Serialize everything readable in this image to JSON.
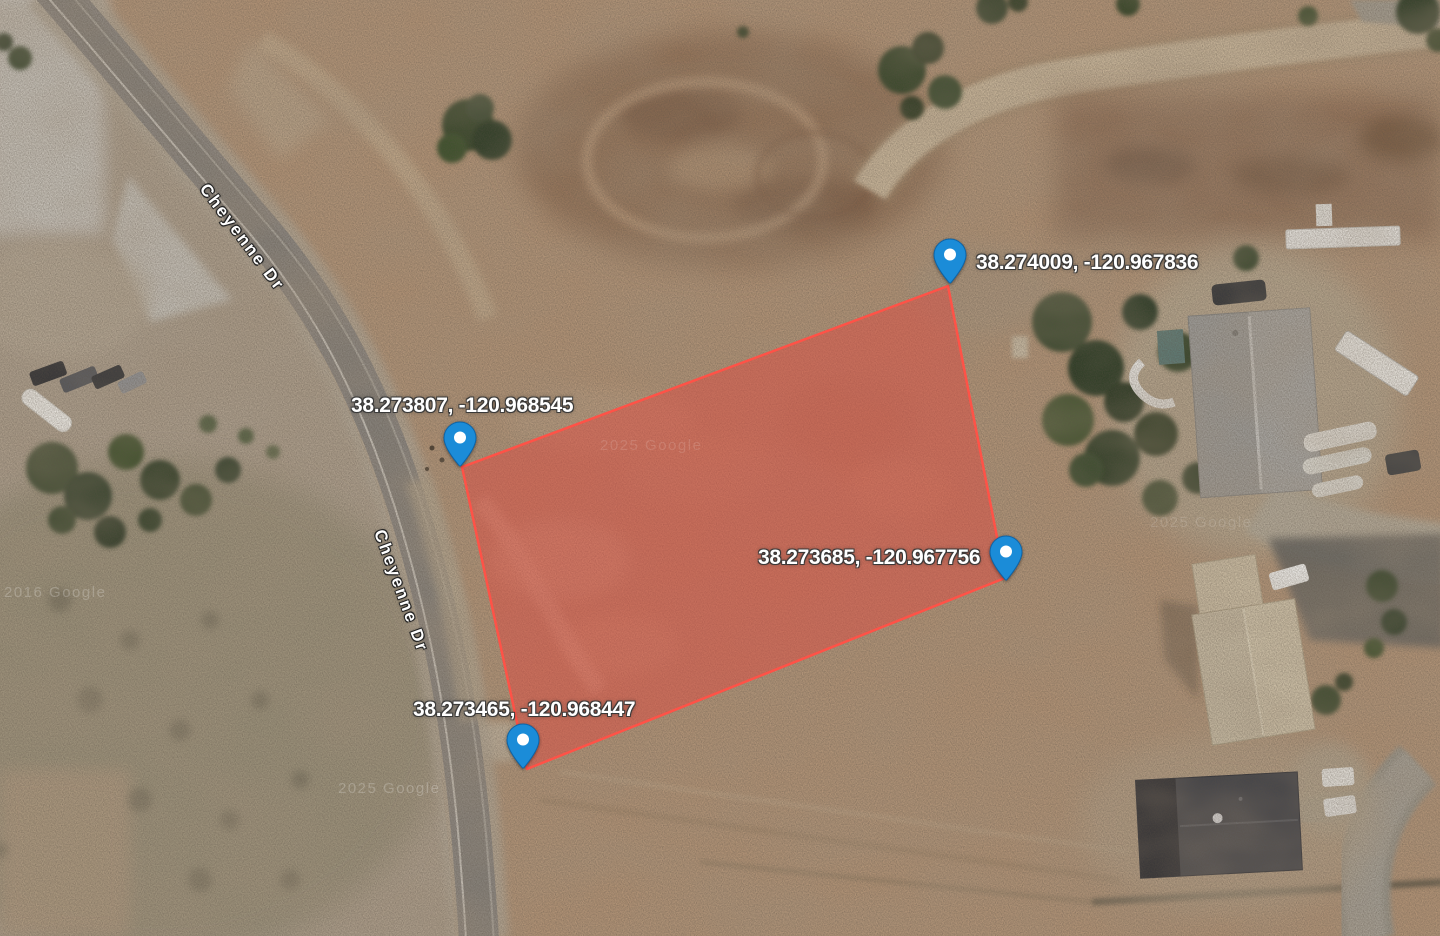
{
  "map": {
    "view_type": "satellite",
    "road_labels": [
      {
        "text": "Cheyenne Dr"
      },
      {
        "text": "Cheyenne Dr"
      }
    ],
    "markers": [
      {
        "label": "38.274009, -120.967836"
      },
      {
        "label": "38.273807, -120.968545"
      },
      {
        "label": "38.273685, -120.967756"
      },
      {
        "label": "38.273465, -120.968447"
      }
    ],
    "parcel": {
      "fill_color": "#e4463c",
      "fill_opacity": "0.46",
      "stroke_color": "#ff5247"
    },
    "pin_color": "#1b8cd8",
    "watermarks": [
      "2016 Google",
      "2025 Google",
      "2025 Google",
      "2025 Google"
    ]
  }
}
